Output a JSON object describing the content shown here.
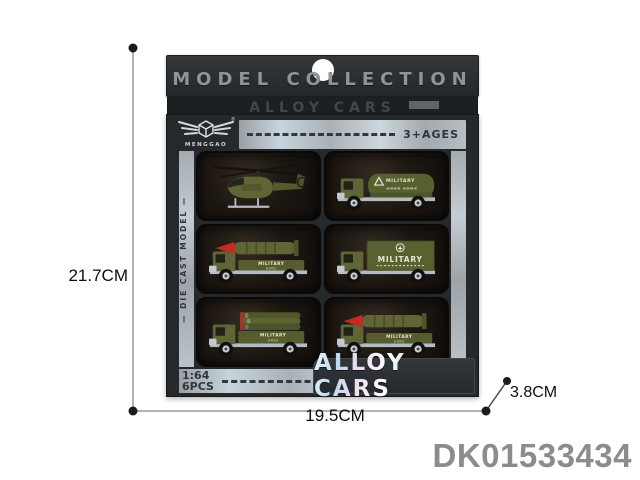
{
  "package": {
    "header_title": "MODEL COLLECTION",
    "flap_title": "ALLOY CARS",
    "brand": "MENGGAO",
    "registered": "®",
    "age_label": "3+AGES",
    "side_label": "—  DIE CAST MODEL  —",
    "scale_label": "1:64",
    "pcs_label": "6PCS",
    "banner_title": "ALLOY CARS"
  },
  "vehicles": [
    {
      "type": "military-helicopter",
      "label": ""
    },
    {
      "type": "military-tanker-truck",
      "label": "MILITARY",
      "marking": "«««« ««««"
    },
    {
      "type": "missile-launcher-truck",
      "label": "MILITARY",
      "marking": "JH003"
    },
    {
      "type": "military-cargo-truck",
      "label": "MILITARY",
      "marking": "✚"
    },
    {
      "type": "pipe-transport-truck",
      "label": "MILITARY",
      "marking": "JH003"
    },
    {
      "type": "missile-launcher-truck",
      "label": "MILITARY",
      "marking": "JH003"
    }
  ],
  "annotations": {
    "height": "21.7CM",
    "width": "19.5CM",
    "depth": "3.8CM",
    "product_code": "DK01533434"
  },
  "colors": {
    "box_dark": "#26292c",
    "header_text": "#8e959a",
    "silver_strip": "#b3babf",
    "army_green": "#5f6536",
    "missile_red": "#c62a21",
    "code_gray": "#8c8c8c",
    "background": "#ffffff"
  }
}
